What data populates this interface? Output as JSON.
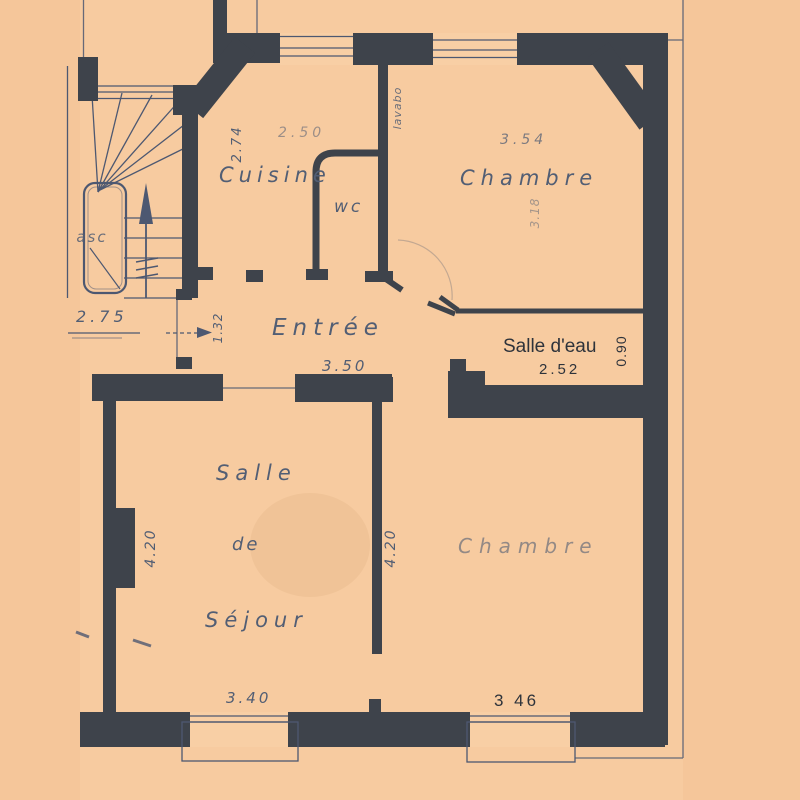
{
  "palette": {
    "paper_outer": "#f5c69a",
    "paper_inner": "#f8cfa5",
    "wall": "#3e434b",
    "ink_lines": "#4d5871",
    "hand_text": "#525e74",
    "print_text": "#2e333b"
  },
  "rooms": {
    "cuisine": "Cuisine",
    "wc": "wc",
    "entree": "Entrée",
    "chambre_top": "Chambre",
    "salle_deau": "Salle d'eau",
    "sejour_line1": "Salle",
    "sejour_line2": "de",
    "sejour_line3": "Séjour",
    "chambre_bottom": "Chambre",
    "elevator": "asc",
    "lavabo": "lavabo"
  },
  "dimensions": {
    "cuisine_depth": "2.74",
    "cuisine_width": "2.50",
    "chambre_top_width": "3.54",
    "chambre_top_depth": "3.18",
    "hall_width": "2.75",
    "hall_door": "1.32",
    "entree_width": "3.50",
    "salle_deau_width": "2.52",
    "salle_deau_depth": "0.90",
    "sejour_depth_left": "4.20",
    "sejour_depth_right": "4.20",
    "sejour_width": "3.40",
    "chambre_bottom_width": "3 46"
  }
}
